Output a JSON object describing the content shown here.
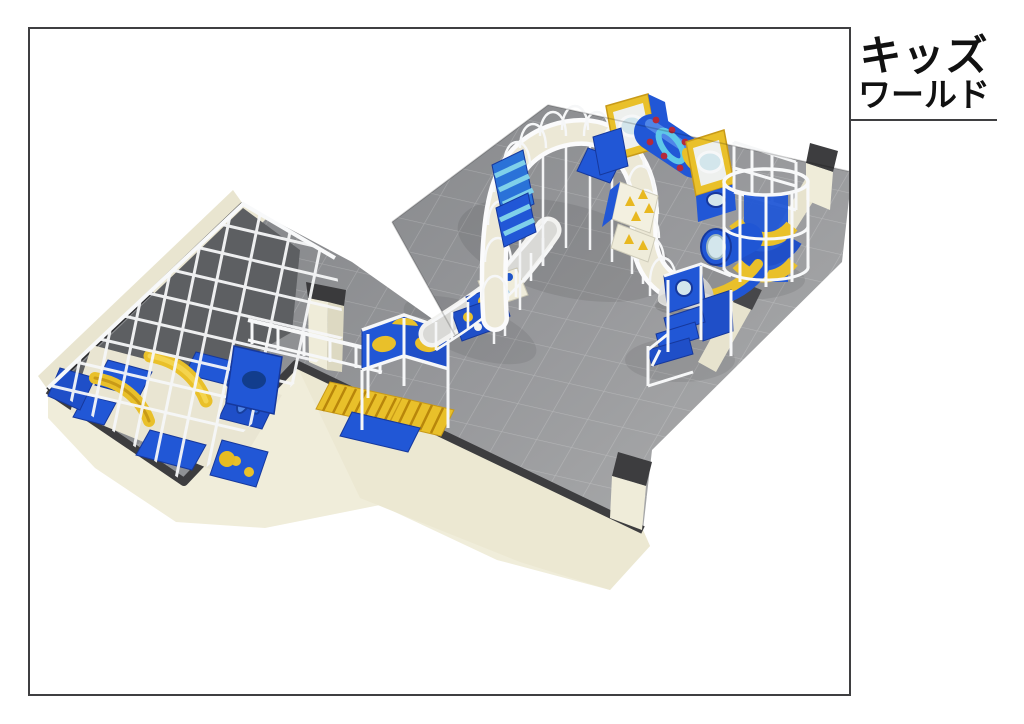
{
  "title_block": {
    "line1": "キッズ",
    "line2": "ワールド"
  },
  "scene": {
    "label": "3D isometric render of an indoor kids playground floor plan",
    "elements": [
      {
        "name": "tiled-floor",
        "color": "#96979a"
      },
      {
        "name": "perimeter-walls",
        "color": "#efecd9"
      },
      {
        "name": "wall-cut-tops",
        "color": "#3d3d3f"
      },
      {
        "name": "left-play-room-structure",
        "colors": [
          "#2157d6",
          "#e9c02a",
          "#f8f9fa"
        ]
      },
      {
        "name": "curved-elevated-walkway",
        "color": "#f8f9fa"
      },
      {
        "name": "porthole-window-boxes",
        "colors": [
          "#e9c02a",
          "#d3e6ec"
        ]
      },
      {
        "name": "crawl-tunnel-red-dots",
        "colors": [
          "#2157d6",
          "#5fc8e8",
          "#b52a3a"
        ]
      },
      {
        "name": "spiral-slide-tower",
        "colors": [
          "#e9c02a",
          "#2157d6"
        ]
      },
      {
        "name": "igloo-dome",
        "color": "#e6e6e4"
      },
      {
        "name": "climbing-steps-unit",
        "color": "#2157d6"
      },
      {
        "name": "roller-lanes",
        "color": "#e9c02a"
      },
      {
        "name": "polka-dot-panels",
        "colors": [
          "#2157d6",
          "#efecda"
        ]
      },
      {
        "name": "spinner-toy",
        "color": "#2f6fe4"
      }
    ]
  },
  "palette": {
    "background": "#ffffff",
    "border": "#3f3f41",
    "floor": "#96979a",
    "wall_cream": "#f0edda",
    "cut_dark": "#3d3d3f",
    "play_blue": "#2157d6",
    "play_yellow": "#e9c02a",
    "frame_white": "#f8f9fa",
    "glass_blue": "#d3e6ec",
    "dot_red": "#b52a3a"
  }
}
